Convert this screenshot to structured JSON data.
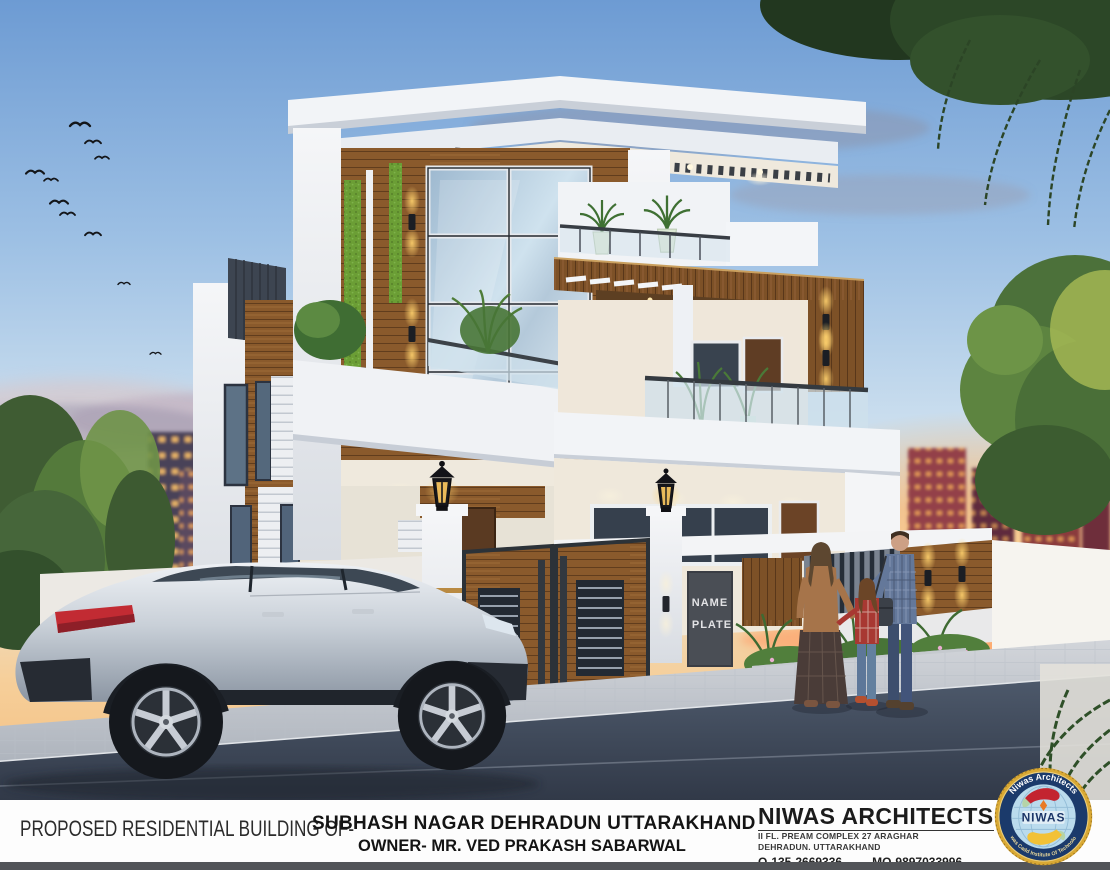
{
  "caption": {
    "prefix": "PROPOSED RESIDENTIAL BUILDING OF-",
    "location": "SUBHASH NAGAR DEHRADUN UTTARAKHAND",
    "owner": "OWNER- MR. VED PRAKASH SABARWAL"
  },
  "firm": {
    "name": "NIWAS ARCHITECTS",
    "address_line1": "II FL. PREAM COMPLEX 27 ARAGHAR",
    "address_line2": "DEHRADUN. UTTARAKHAND",
    "phone_office": "O-135-2669336",
    "phone_mobile": "MO-9897033996"
  },
  "logo": {
    "arc_top": "Niwas Architects",
    "arc_bottom": "Niwas Cadd Institute Of Technology",
    "center": "NIWAS"
  },
  "scene": {
    "name_plate": {
      "line1": "NAME",
      "line2": "PLATE"
    }
  },
  "colors": {
    "sky_top": "#6d9bd3",
    "sunset_glow": "#ffb05e",
    "wall_white": "#f2f4f7",
    "wall_cream": "#efe8db",
    "wood": "#8a5a2c",
    "glass": "#c3d6e6",
    "grass_green": "#6b9e35",
    "lamp_amber": "#ffd26e",
    "road": "#3b4452",
    "bottom_bar": "#525458",
    "logo_navy": "#1b3a6b",
    "logo_gold": "#d9a934",
    "logo_red": "#c32430",
    "logo_yellow": "#f2c136"
  }
}
